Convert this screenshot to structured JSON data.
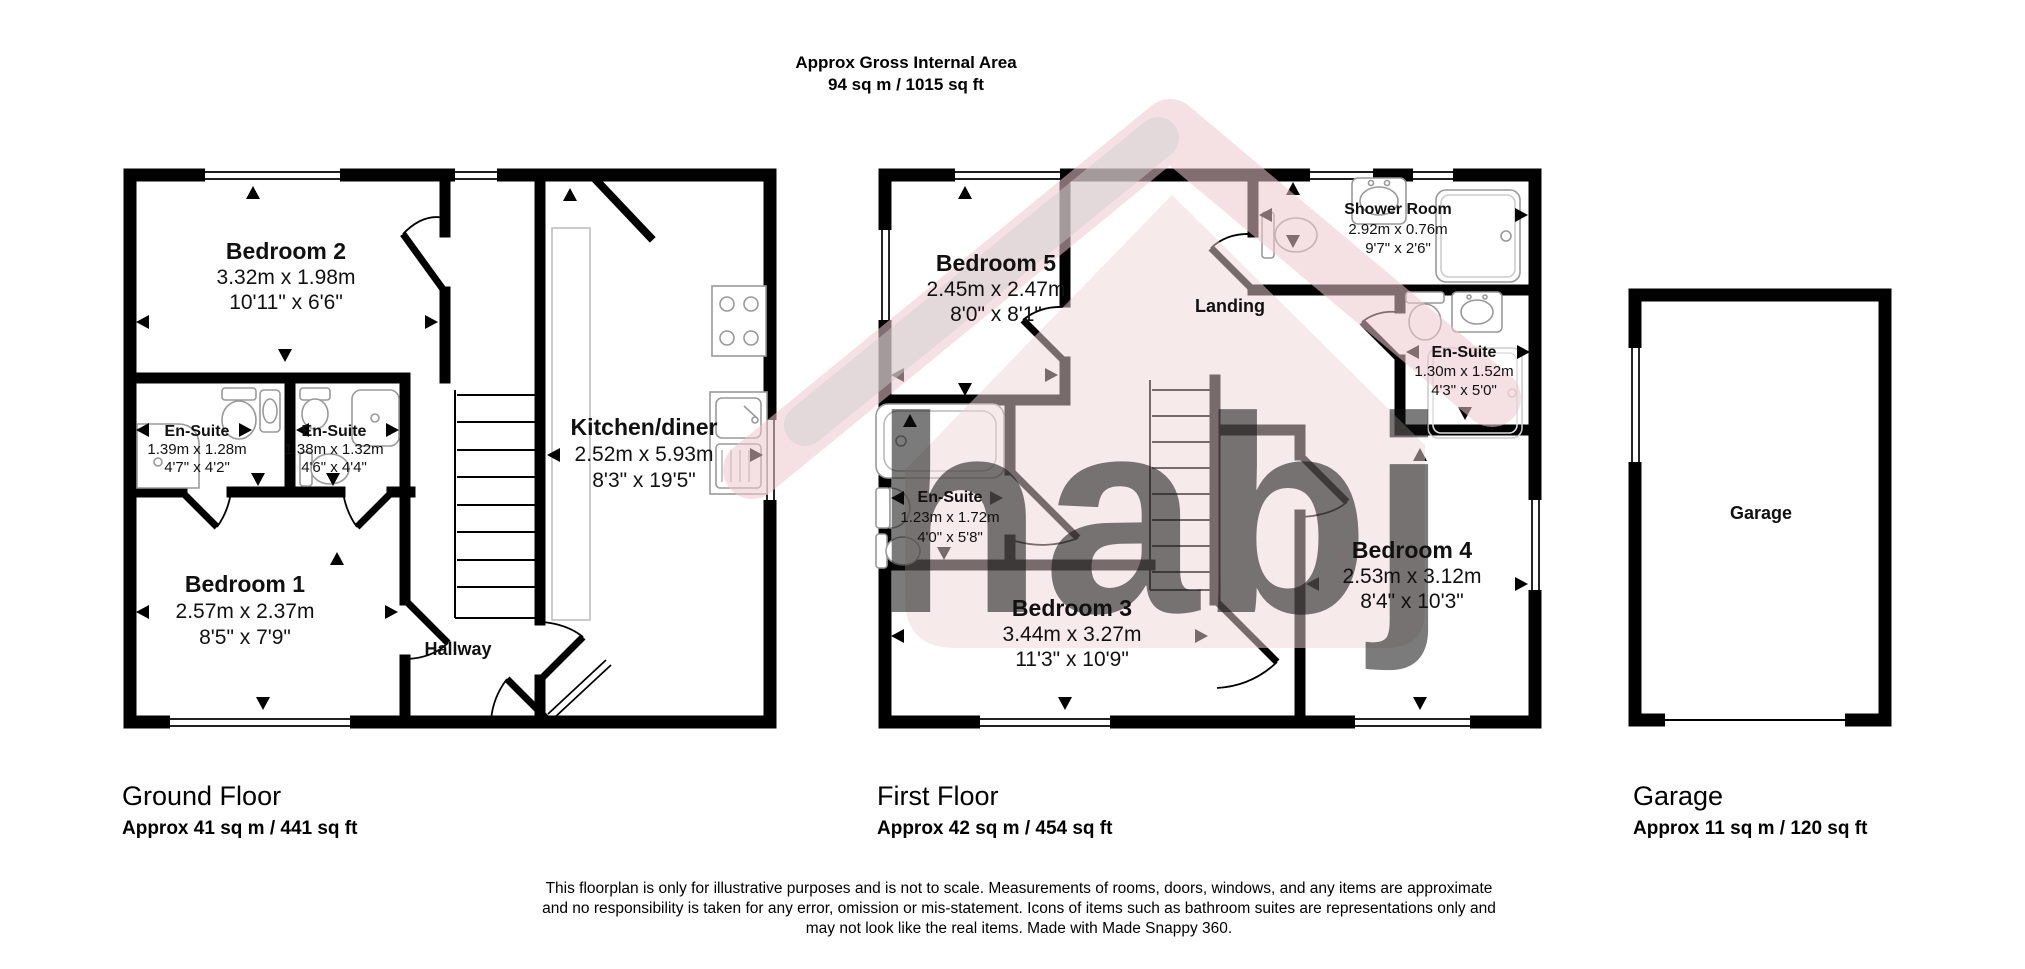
{
  "header": {
    "title": "Approx Gross Internal Area",
    "subtitle": "94 sq m / 1015 sq ft"
  },
  "floors": {
    "ground": {
      "title": "Ground Floor",
      "area": "Approx 41 sq m / 441 sq ft"
    },
    "first": {
      "title": "First Floor",
      "area": "Approx 42 sq m / 454 sq ft"
    },
    "garage": {
      "title": "Garage",
      "area": "Approx 11 sq m / 120 sq ft"
    }
  },
  "rooms": {
    "bedroom2": {
      "name": "Bedroom 2",
      "metric": "3.32m x 1.98m",
      "imperial": "10'11\" x 6'6\""
    },
    "ensuite_gf_1": {
      "name": "En-Suite",
      "metric": "1.39m x 1.28m",
      "imperial": "4'7\" x 4'2\""
    },
    "ensuite_gf_2": {
      "name": "En-Suite",
      "metric": "1.38m x 1.32m",
      "imperial": "4'6\" x 4'4\""
    },
    "kitchen": {
      "name": "Kitchen/diner",
      "metric": "2.52m x 5.93m",
      "imperial": "8'3\" x 19'5\""
    },
    "bedroom1": {
      "name": "Bedroom 1",
      "metric": "2.57m x 2.37m",
      "imperial": "8'5\" x 7'9\""
    },
    "hallway": {
      "name": "Hallway"
    },
    "bedroom5": {
      "name": "Bedroom 5",
      "metric": "2.45m x 2.47m",
      "imperial": "8'0\" x 8'1\""
    },
    "landing": {
      "name": "Landing"
    },
    "shower_room": {
      "name": "Shower Room",
      "metric": "2.92m x 0.76m",
      "imperial": "9'7\" x 2'6\""
    },
    "ensuite_ff_right": {
      "name": "En-Suite",
      "metric": "1.30m x 1.52m",
      "imperial": "4'3\" x 5'0\""
    },
    "ensuite_ff_mid": {
      "name": "En-Suite",
      "metric": "1.23m x 1.72m",
      "imperial": "4'0\" x 5'8\""
    },
    "bedroom3": {
      "name": "Bedroom 3",
      "metric": "3.44m x 3.27m",
      "imperial": "11'3\" x 10'9\""
    },
    "bedroom4": {
      "name": "Bedroom 4",
      "metric": "2.53m x 3.12m",
      "imperial": "8'4\" x 10'3\""
    },
    "garage": {
      "name": "Garage"
    }
  },
  "watermark": {
    "text": "habj"
  },
  "disclaimer": {
    "line1": "This floorplan is only for illustrative purposes and is not to scale. Measurements of rooms, doors, windows, and any items are approximate",
    "line2": "and no responsibility is taken for any error, omission or mis-statement. Icons of items such as bathroom suites are representations only and",
    "line3": "may not look like the real items. Made with Made Snappy 360."
  },
  "colors": {
    "wall": "#000000",
    "watermark_pink": "#eed5d7",
    "watermark_grey": "#bdbdbd"
  }
}
